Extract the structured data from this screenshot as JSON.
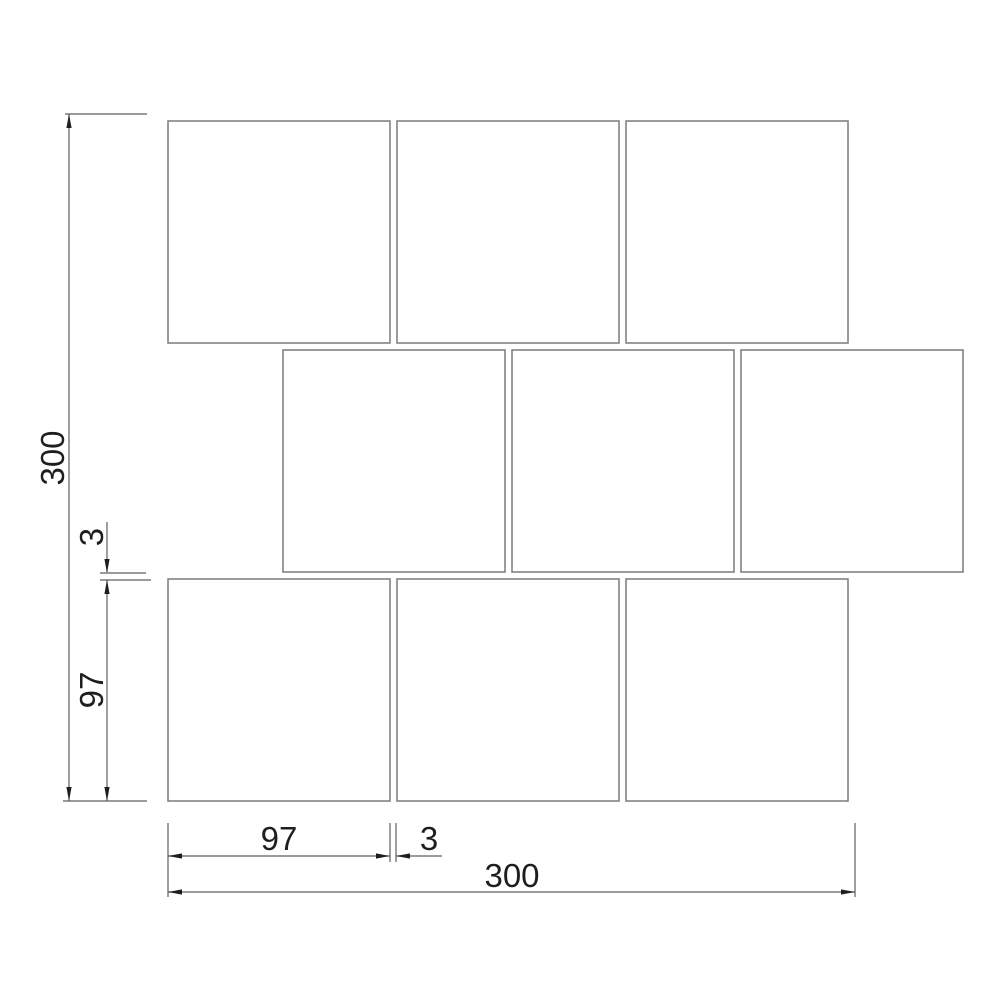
{
  "drawing": {
    "title": "staggered-square-tile-layout-drawing",
    "background_color": "#ffffff",
    "tile_fill_color": "#ffffff",
    "tile_border_color": "#7a7a7a",
    "dimension_line_color": "#5f5f5f",
    "text_color": "#1e1e1e",
    "tile_rows": 3,
    "tiles_per_row": 3,
    "stagger": "middle row offset by half tile pitch"
  },
  "dimensions": {
    "left_overall": {
      "value": "300",
      "orientation": "vertical",
      "measures": "overall height"
    },
    "left_gap": {
      "value": "3",
      "orientation": "vertical",
      "measures": "grout gap between rows"
    },
    "left_tile": {
      "value": "97",
      "orientation": "vertical",
      "measures": "tile height"
    },
    "bottom_tile": {
      "value": "97",
      "orientation": "horizontal",
      "measures": "tile width"
    },
    "bottom_gap": {
      "value": "3",
      "orientation": "horizontal",
      "measures": "grout gap between tiles"
    },
    "bottom_overall": {
      "value": "300",
      "orientation": "horizontal",
      "measures": "overall width"
    }
  }
}
